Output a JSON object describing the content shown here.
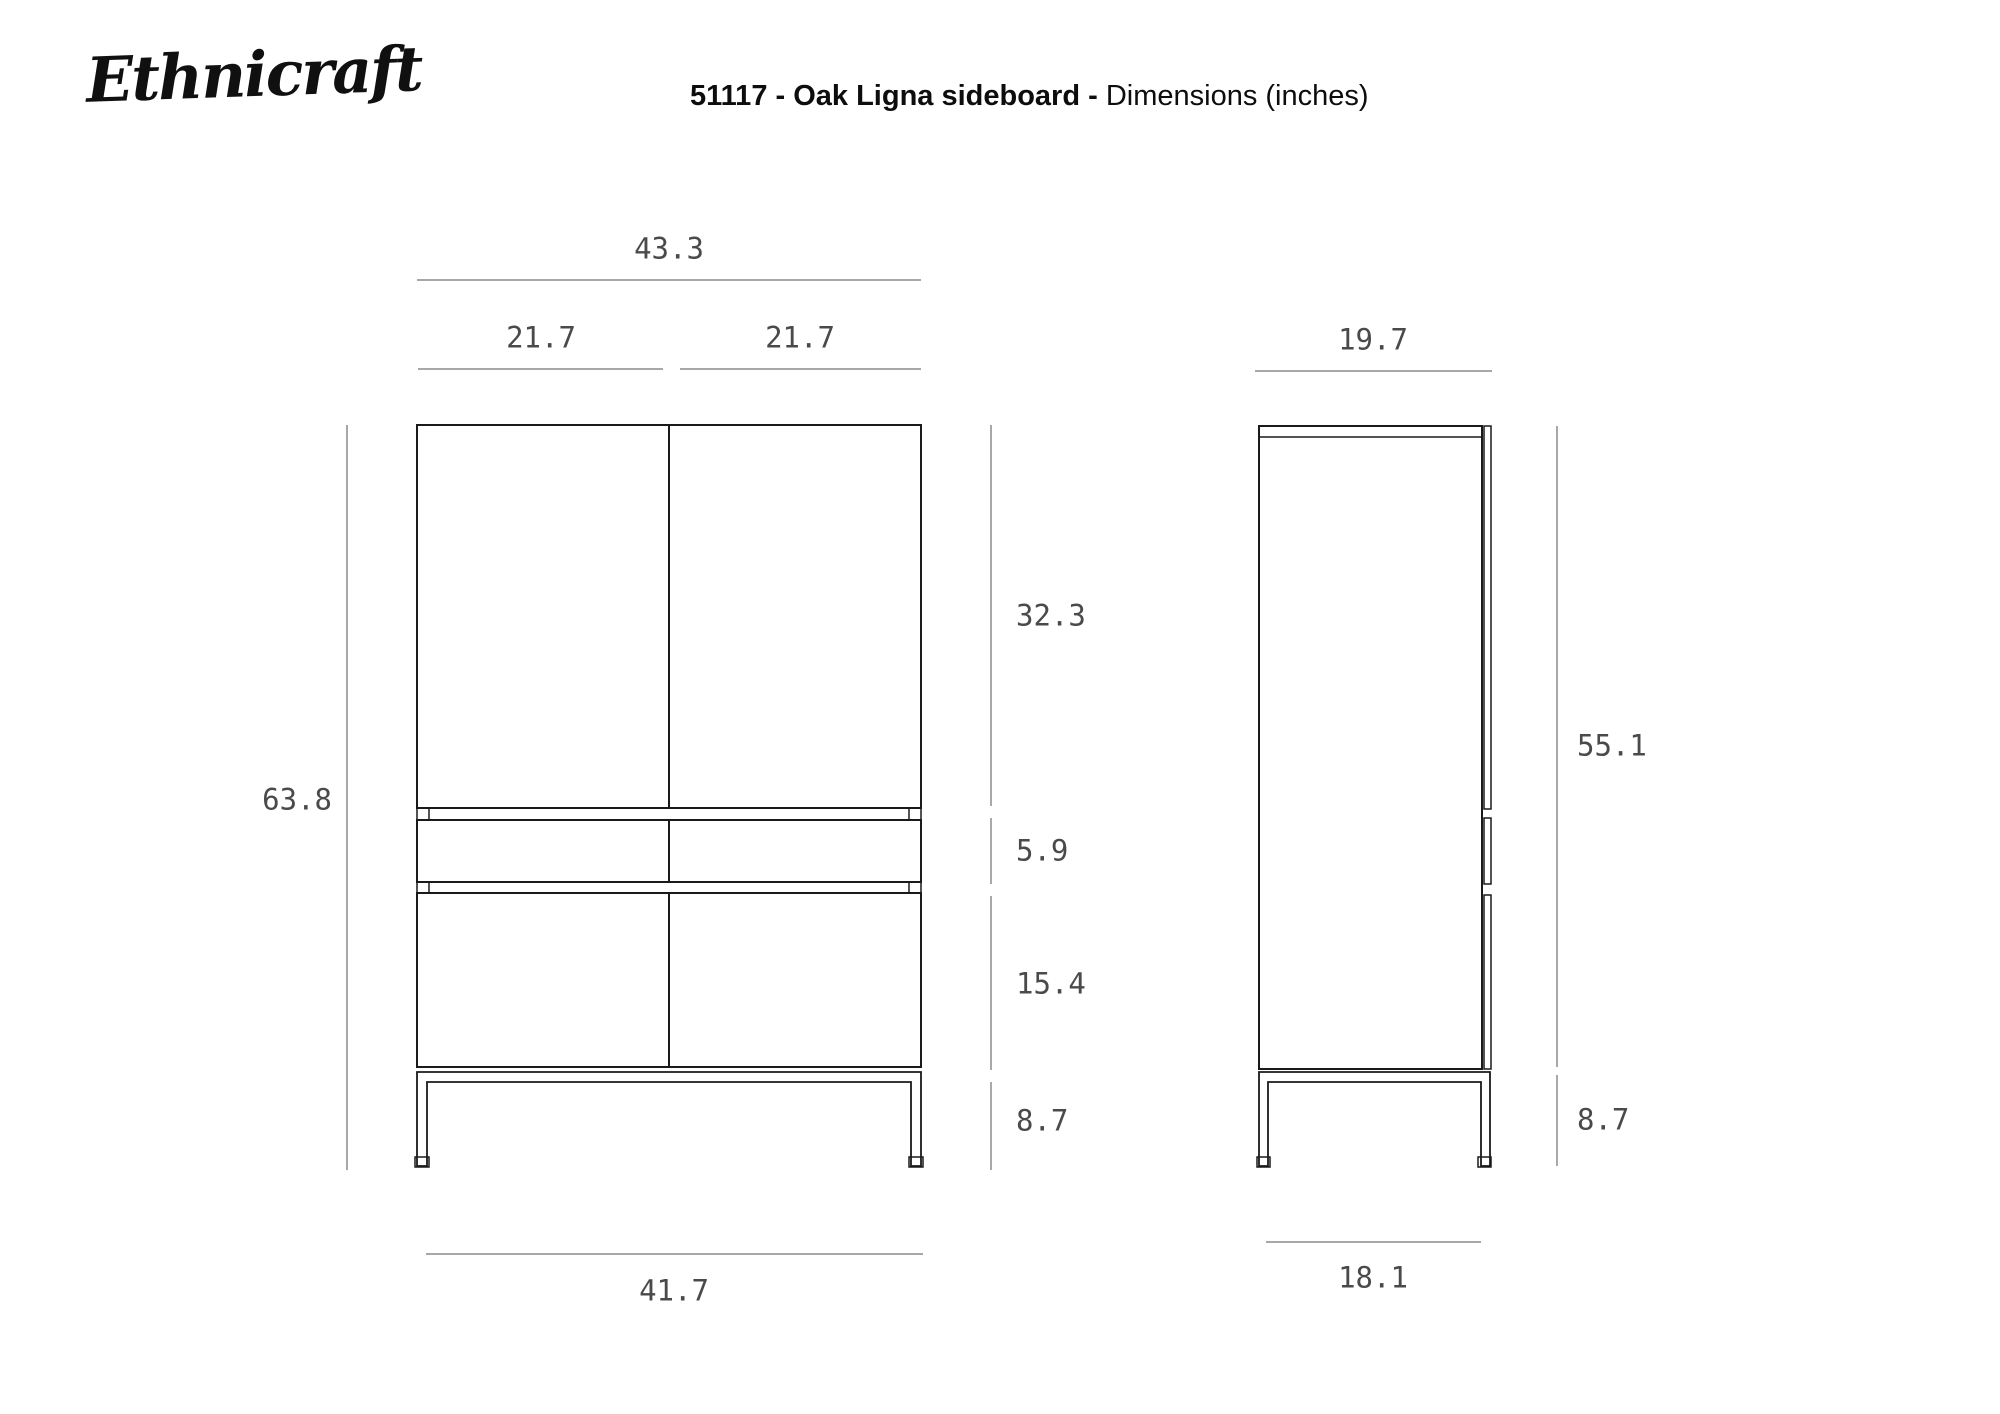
{
  "header": {
    "logo": "Ethnicraft",
    "title_bold": "51117 - Oak Ligna sideboard - ",
    "title_regular": "Dimensions (inches)"
  },
  "units": "inches",
  "product": {
    "sku": "51117",
    "name": "Oak Ligna sideboard"
  },
  "dims": {
    "front_total_width": "43.3",
    "front_left_door_width": "21.7",
    "front_right_door_width": "21.7",
    "side_depth": "19.7",
    "front_total_height": "63.8",
    "front_top_section_height": "32.3",
    "front_drawer_height": "5.9",
    "front_bottom_door_height": "15.4",
    "front_base_height": "8.7",
    "front_base_width": "41.7",
    "side_body_height": "55.1",
    "side_base_height": "8.7",
    "side_base_depth": "18.1"
  },
  "colors": {
    "outline": "#1a1a1a",
    "dim_line": "#8c8c8c",
    "dim_text": "#4a4a4a",
    "background": "#ffffff"
  }
}
